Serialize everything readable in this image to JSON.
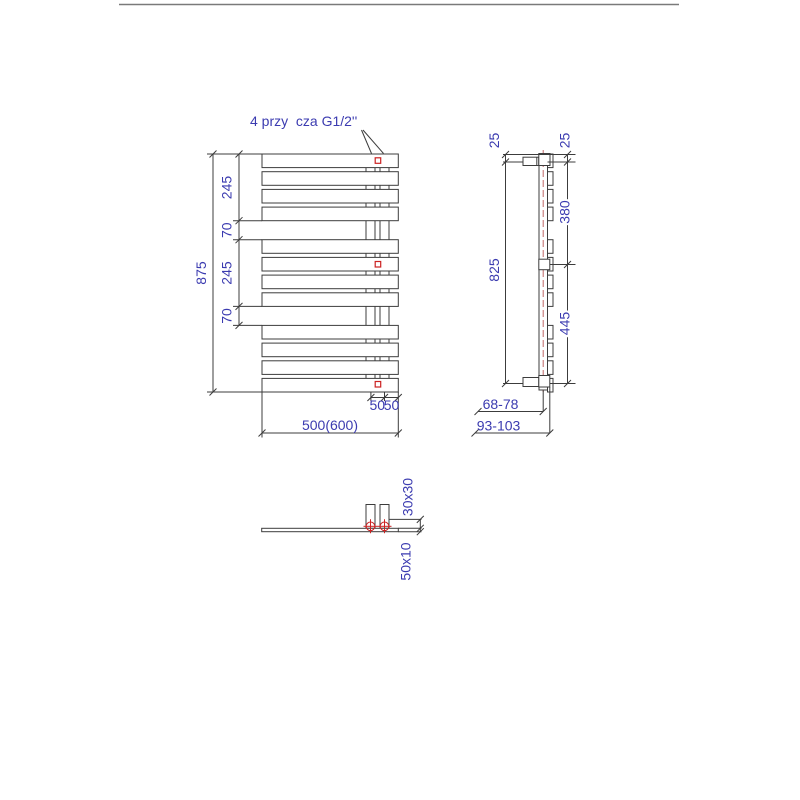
{
  "connections_label": "4 przy  cza G1/2''",
  "front_view": {
    "overall_height": "875",
    "segments": [
      "245",
      "70",
      "245",
      "70"
    ],
    "overall_width": "500(600)",
    "connection_offsets": [
      "50",
      "50"
    ]
  },
  "side_view": {
    "top_offsets": [
      "25",
      "25"
    ],
    "upper_span": "380",
    "axis_span": "825",
    "lower_span": "445",
    "wall_to_axis": "68-78",
    "wall_to_front": "93-103"
  },
  "bottom_view": {
    "collector_profile": "30x30",
    "panel_profile": "50x10"
  },
  "colors": {
    "line": "#3c3c3c",
    "dim_text": "#3b3bb0",
    "marker": "#cc2222",
    "centerline": "#c06868",
    "border": "#7a7a7a"
  }
}
